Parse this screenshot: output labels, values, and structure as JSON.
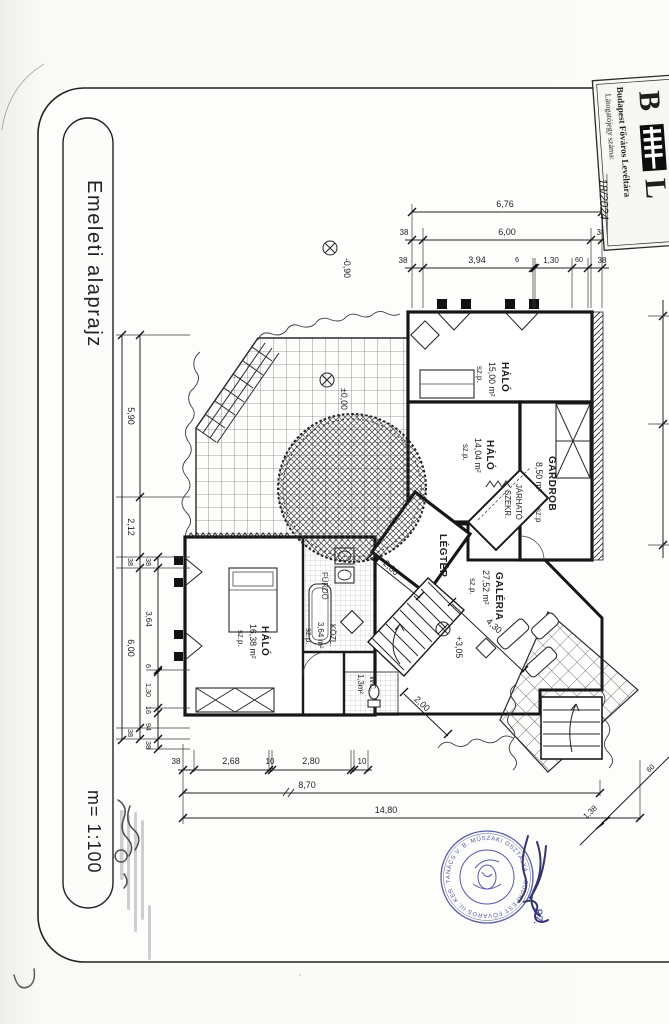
{
  "page": {
    "title": "Emeleti alaprajz",
    "scale": "m= 1:100"
  },
  "archive_stamp": {
    "org": "Budapest Főváros Levéltára",
    "field_label": "Látogatójegy száma:",
    "field_value": "18/2024",
    "logo_b": "B",
    "logo_l": "L"
  },
  "council_stamp": {
    "ring": "BUDAPEST FŐVÁROS III. KER. TANÁCS V. B. MŰSZAKI OSZTÁLYA",
    "handwritten": "87."
  },
  "rooms": {
    "halo15": {
      "name": "HÁLÓ",
      "area": "15,00 m²",
      "note": "sz.p."
    },
    "halo14": {
      "name": "HÁLÓ",
      "area": "14,04 m²",
      "note": "sz.p."
    },
    "gardrob": {
      "name": "GARDROB",
      "area": "8,50 m²",
      "note": "sz:p"
    },
    "jarhato": {
      "line1": "JÁRHATÓ",
      "line2": "SZEKR."
    },
    "legter": {
      "name": "LÉGTÉR"
    },
    "galeria": {
      "name": "GALÉRIA",
      "area": "27,52 m²",
      "note": "sz.p."
    },
    "halo16": {
      "name": "HÁLÓ",
      "area": "16,38 m²",
      "note": "sz.p."
    },
    "furdo": {
      "name": "FÜRDŐ"
    },
    "kozl": {
      "name": "KÖZL.",
      "area": "3,64 m²",
      "note": "sz.p."
    },
    "wc": {
      "name": "WC.",
      "area": "1,3m²"
    }
  },
  "levels": {
    "entry": "-0,90",
    "terrace": "±0,00",
    "gallery": "+3,05"
  },
  "dims": {
    "top": {
      "total": "6,76",
      "row2": [
        "38",
        "6,00",
        "38"
      ],
      "row3": [
        "38",
        "3,94",
        "6",
        "1,30",
        "60",
        "38"
      ]
    },
    "left": {
      "total": "14,78",
      "mid": [
        "5,90",
        "2,12",
        "38",
        "6,00",
        "38"
      ],
      "inner": [
        "38",
        "3,64",
        "6",
        "1,30",
        "16",
        "94",
        "38"
      ]
    },
    "bottom": {
      "row1": [
        "38",
        "2,68",
        "10",
        "2,80",
        "10"
      ],
      "total_mid": "8,70",
      "total": "14,80"
    },
    "diagonal": [
      "1,38",
      "60"
    ],
    "interior": {
      "legter": "2,60",
      "galeria": "4,30",
      "stair": "2,00"
    }
  }
}
